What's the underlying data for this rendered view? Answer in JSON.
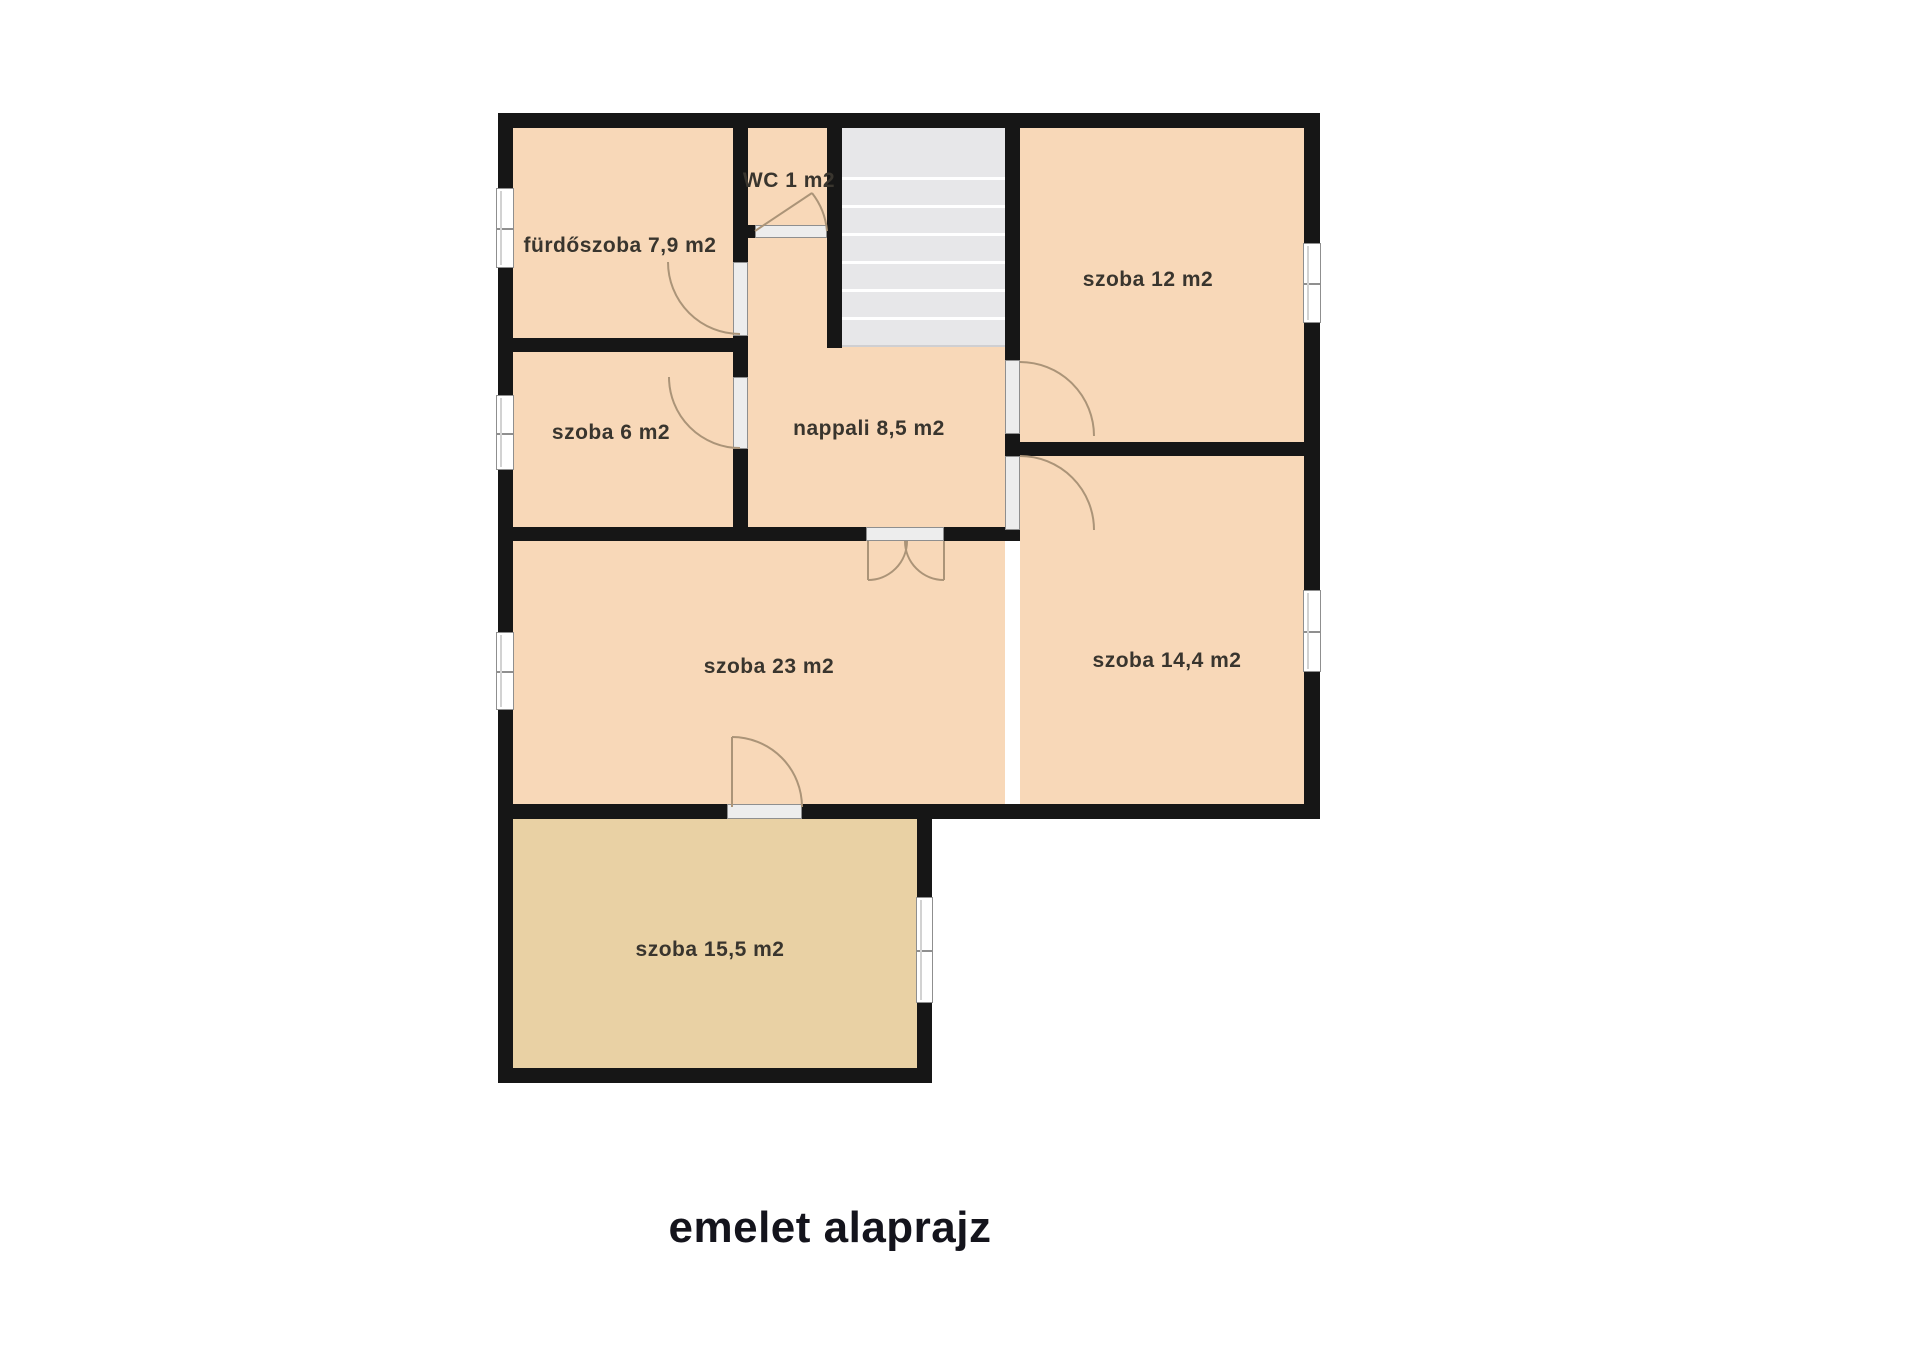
{
  "title": "emelet alaprajz",
  "rooms": {
    "furdoszoba": {
      "name": "fürdőszoba",
      "area": "7,9 m2",
      "label": "fürdőszoba 7,9 m2"
    },
    "wc": {
      "name": "WC",
      "area": "1 m2",
      "label": "WC 1 m2"
    },
    "szoba12": {
      "name": "szoba",
      "area": "12 m2",
      "label": "szoba 12 m2"
    },
    "nappali": {
      "name": "nappali",
      "area": "8,5 m2",
      "label": "nappali 8,5 m2"
    },
    "szoba6": {
      "name": "szoba",
      "area": "6 m2",
      "label": "szoba 6 m2"
    },
    "szoba23": {
      "name": "szoba",
      "area": "23 m2",
      "label": "szoba 23 m2"
    },
    "szoba144": {
      "name": "szoba",
      "area": "14,4 m2",
      "label": "szoba 14,4 m2"
    },
    "szoba155": {
      "name": "szoba",
      "area": "15,5 m2",
      "label": "szoba 15,5 m2"
    }
  },
  "colors": {
    "room_fill": "#f8d8b8",
    "room_fill_bottom": "#e9d1a4",
    "wall": "#161616",
    "stairs_fill": "#e7e7e9",
    "stair_line": "#ffffff",
    "door_frame": "#ededed",
    "frame_border": "#8f8f8f",
    "door_arc": "#ab9478",
    "label_text": "#39352e",
    "title_text": "#14141c",
    "background": "#ffffff"
  }
}
